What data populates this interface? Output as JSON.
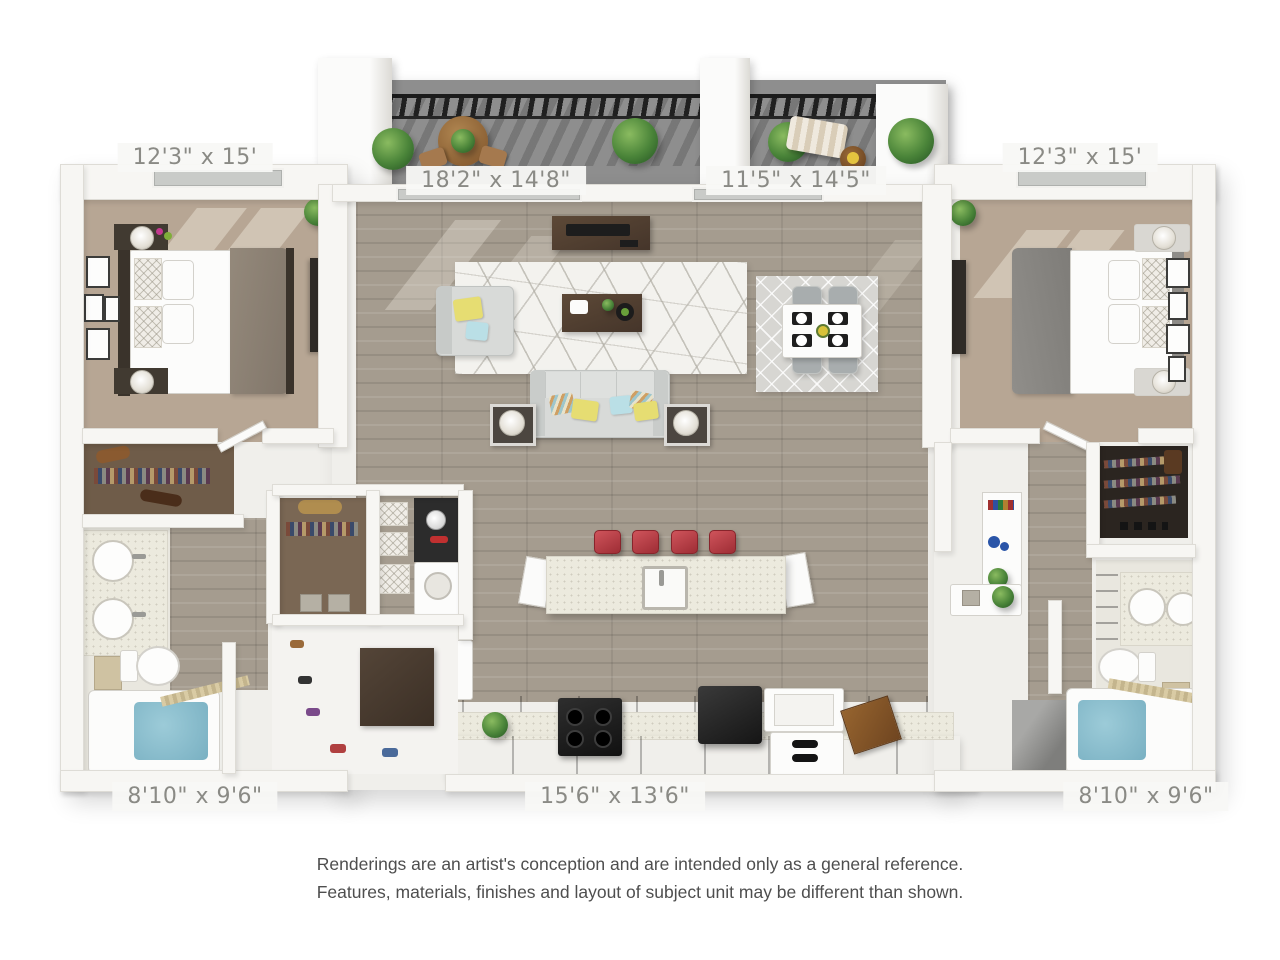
{
  "floorplan": {
    "rooms": {
      "bedroom_left": {
        "dimensions": "12'3\" x 15'"
      },
      "balcony_left": {
        "dimensions": "18'2\" x 14'8\""
      },
      "balcony_right": {
        "dimensions": "11'5\" x 14'5\""
      },
      "bedroom_right": {
        "dimensions": "12'3\" x 15'"
      },
      "bathroom_left": {
        "dimensions": "8'10\" x 9'6\""
      },
      "kitchen": {
        "dimensions": "15'6\" x 13'6\""
      },
      "bathroom_right": {
        "dimensions": "8'10\" x 9'6\""
      }
    },
    "colors": {
      "background": "#ffffff",
      "wall": "#f7f6f3",
      "carpet": "#b7a694",
      "hardwood": "#a59c8f",
      "balcony_concrete": "#8e8e8e",
      "railing": "#202020",
      "counter_speckle": "#eceade",
      "cabinet_wood": "#5d4937",
      "stool_red": "#b4414b",
      "accent_yellow": "#e6dd72",
      "accent_blue": "#badfe6",
      "tub_water": "#83b8c9",
      "label_text": "#8a8a85",
      "disclaimer_text": "#4e4e4e"
    }
  },
  "disclaimer": {
    "line1": "Renderings are an artist's conception and are intended only as a general reference.",
    "line2": "Features, materials, finishes and layout of subject unit may be different than shown."
  }
}
